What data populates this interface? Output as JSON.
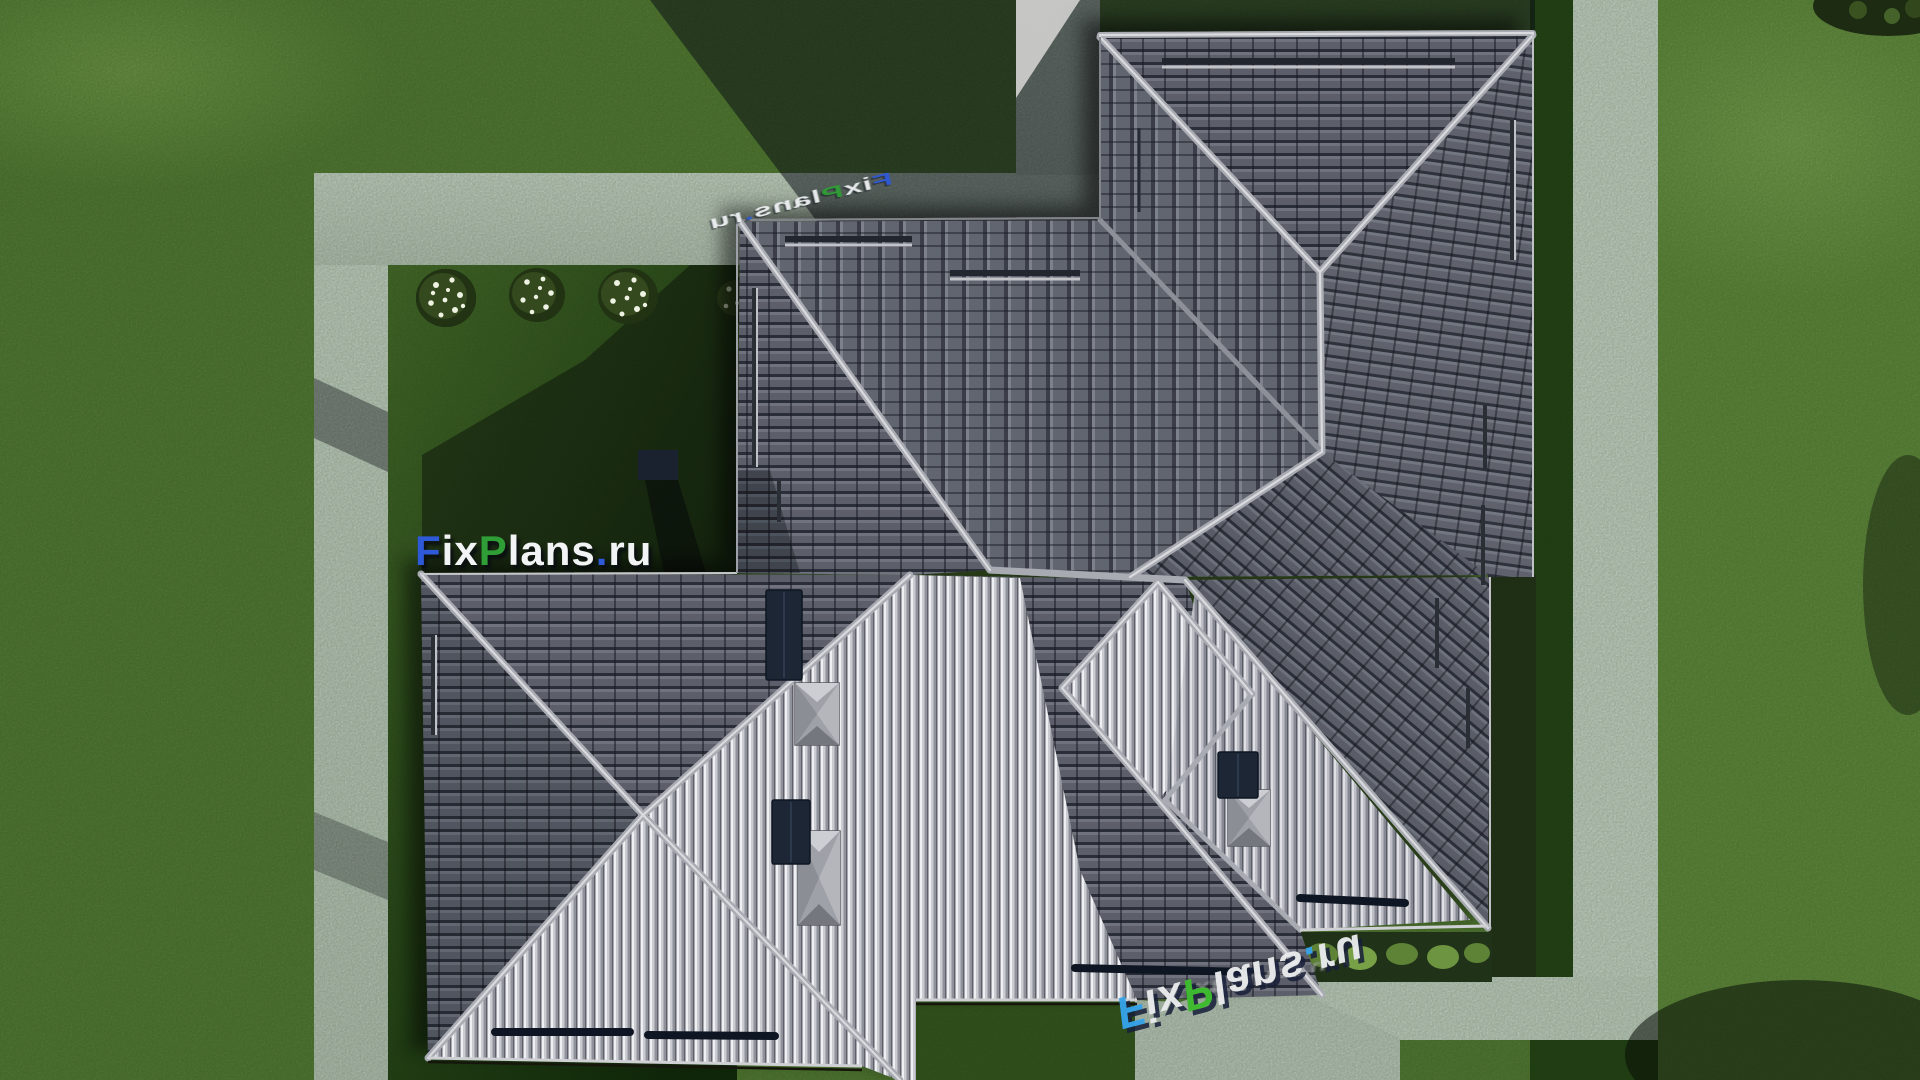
{
  "scene": {
    "description": "Top-down aerial 3D render of a large hip-roofed house with dark tiled roof, concrete garden paths, lawn, flowering shrubs and cast shadows",
    "brand": "FixPlans.ru"
  },
  "watermarks": [
    {
      "name": "watermark-main",
      "text": "FixPlans.ru",
      "letters": [
        "F",
        "i",
        "x",
        "P",
        "l",
        "a",
        "n",
        "s",
        ".",
        "r",
        "u"
      ],
      "colors": [
        "#2e59d8",
        "#f2f3f5",
        "#f2f3f5",
        "#2f9e36",
        "#f2f3f5",
        "#f2f3f5",
        "#f2f3f5",
        "#f2f3f5",
        "#2e59d8",
        "#f2f3f5",
        "#f2f3f5"
      ]
    },
    {
      "name": "watermark-top-perspective",
      "text": "FixPlans.ru",
      "letters": [
        "F",
        "i",
        "x",
        "P",
        "l",
        "a",
        "n",
        "s",
        ".",
        "r",
        "u"
      ],
      "colors": [
        "#2e59d8",
        "#eef0f2",
        "#eef0f2",
        "#2f9e36",
        "#eef0f2",
        "#eef0f2",
        "#eef0f2",
        "#eef0f2",
        "#2e59d8",
        "#eef0f2",
        "#eef0f2"
      ]
    },
    {
      "name": "watermark-bottom-reflection",
      "text": "FixPlans.ru",
      "letters": [
        "F",
        "i",
        "x",
        "P",
        "l",
        "a",
        "n",
        "s",
        ".",
        "r",
        "u"
      ],
      "colors": [
        "#35a2e8",
        "#e8eaec",
        "#e8eaec",
        "#3dbb2e",
        "#e8eaec",
        "#e8eaec",
        "#e8eaec",
        "#e8eaec",
        "#35a2e8",
        "#e8eaec",
        "#e8eaec"
      ]
    },
    {
      "name": "watermark-bottom-debris",
      "text": "FixPlans.ru",
      "letters": [
        "F",
        "i",
        "x",
        "P",
        "l",
        "a",
        "n",
        "s",
        ".",
        "r",
        "u"
      ],
      "colors": [
        "#9b9c9f",
        "#9b9c9f",
        "#9b9c9f",
        "#9b9c9f",
        "#9b9c9f",
        "#9b9c9f",
        "#9b9c9f",
        "#9b9c9f",
        "#9b9c9f",
        "#9b9c9f",
        "#9b9c9f"
      ]
    }
  ],
  "palette": {
    "lawn": "#5d7839",
    "lawn_bright": "#6b8843",
    "lawn_shadow": "#16220e",
    "path": "#cfcfcd",
    "path_bright": "#d8d8d6",
    "roof_dark": "#5c5f69",
    "roof_bright": "#c6c7cc",
    "ridge": "#a9abb3",
    "solar_panel_navy": "#1b2536",
    "flower_white": "#f2f4ea"
  }
}
